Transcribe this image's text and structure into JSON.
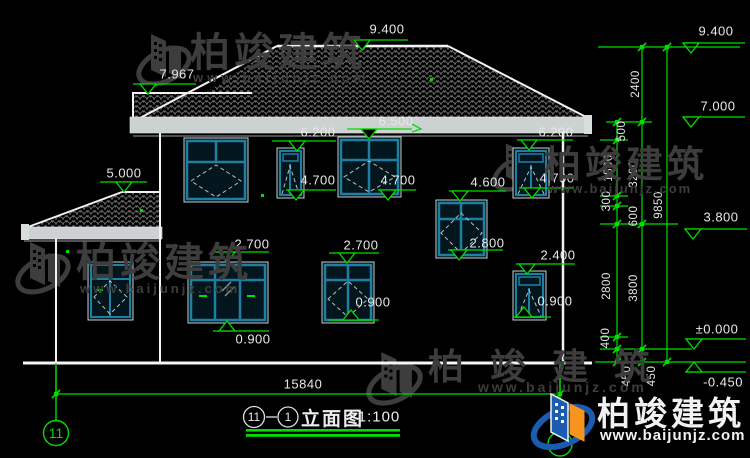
{
  "title": {
    "view_bubble_left": "11",
    "view_bubble_right": "1",
    "name": "立面图",
    "scale": "1:100"
  },
  "axis": {
    "left_bubble": "11"
  },
  "dims": {
    "total_width": "15840",
    "chain_2400": "2400",
    "chain_500": "500",
    "chain_1800": "1800",
    "chain_3200": "3200",
    "chain_300": "300",
    "chain_600": "600",
    "chain_9850": "9850",
    "chain_2800": "2800",
    "chain_3800": "3800",
    "chain_400": "400",
    "chain_450_a": "450",
    "chain_450_b": "450"
  },
  "levels": {
    "ridge_left": "9.400",
    "wing_ridge": "7.967",
    "porch_roof": "5.000",
    "eave_6500": "6.500",
    "eave_6200_left": "6.200",
    "eave_6200_right": "6.200",
    "win_top_4700_a": "4.700",
    "win_top_4700_b": "4.700",
    "win_top_4700_c": "4.700",
    "win_top_4600": "4.600",
    "win_top_2700_a": "2.700",
    "win_top_2700_b": "2.700",
    "win_sill_2800": "2.800",
    "win_top_2400": "2.400",
    "win_sill_0900_a": "0.900",
    "win_sill_0900_b": "0.900",
    "win_sill_0900_c": "0.900",
    "right_9400": "9.400",
    "right_7000": "7.000",
    "right_3800": "3.800",
    "right_zero": "±0.000",
    "right_minus_0450": "-0.450"
  },
  "watermark": {
    "brand": "柏竣建筑",
    "url": "www.baijunjz.com"
  },
  "logo": {
    "brand": "柏竣建筑",
    "url": "www.baijunjz.com"
  },
  "colors": {
    "background": "#000000",
    "line_white": "#f2f2f2",
    "dim_green": "#00dd00",
    "window_teal": "#1f7fa3",
    "fascia_gray": "#ccd1d1",
    "watermark_gray": "#3d3d3d",
    "logo_blue": "#1c5cb0",
    "logo_orange": "#f7941d"
  }
}
